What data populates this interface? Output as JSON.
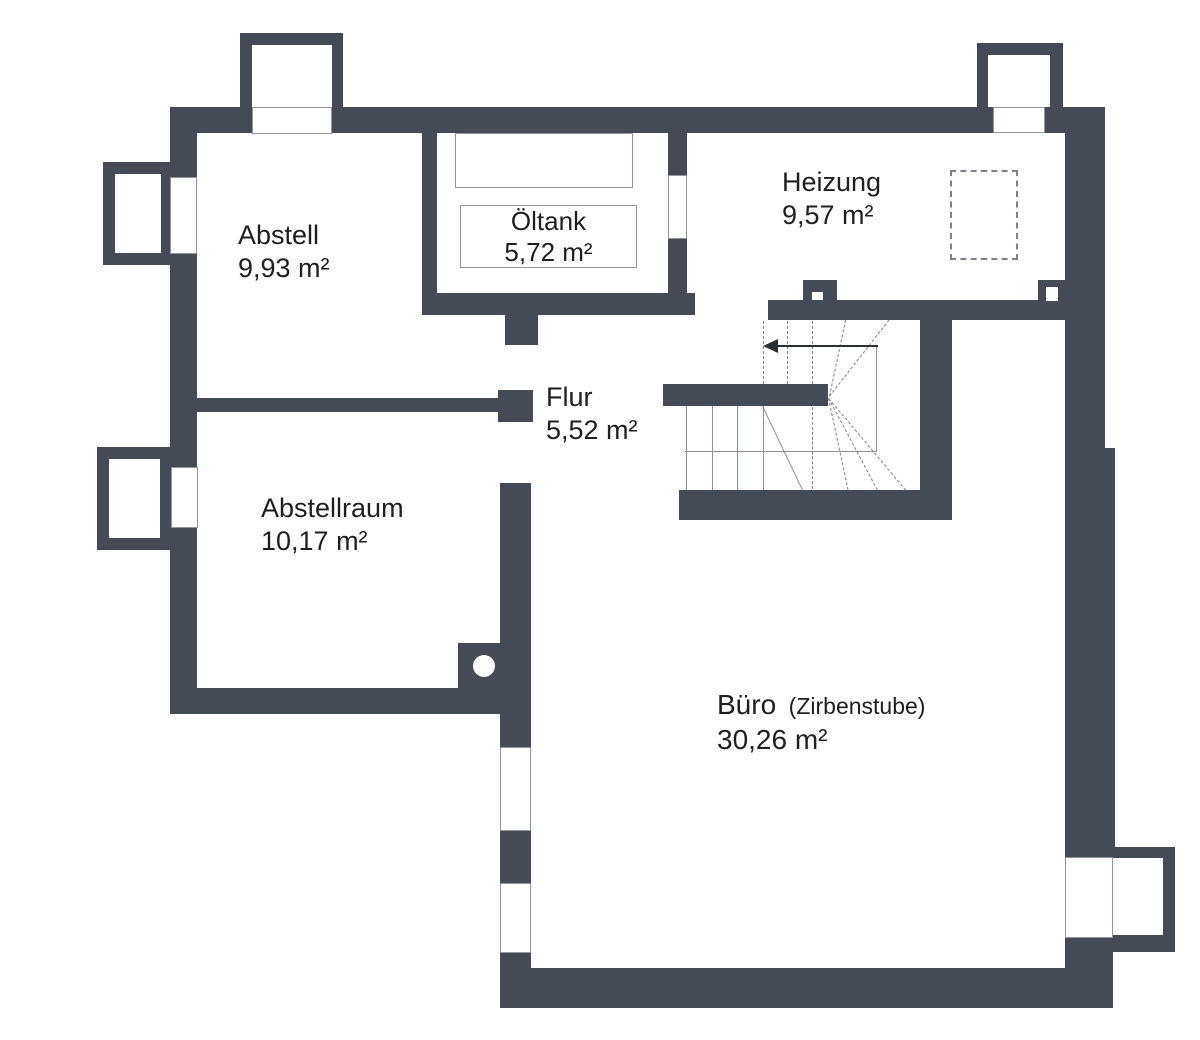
{
  "palette": {
    "wall": "#454b56",
    "thin_line": "#9097a0",
    "dashed_line": "#7d838d",
    "stair_line": "#8a9099",
    "arrow": "#2a2f36",
    "text": "#1f1f1f",
    "background": "#ffffff"
  },
  "rooms": {
    "abstell": {
      "name": "Abstell",
      "area": "9,93 m²"
    },
    "oeltank": {
      "name": "Öltank",
      "area": "5,72 m²"
    },
    "heizung": {
      "name": "Heizung",
      "area": "9,57 m²"
    },
    "flur": {
      "name": "Flur",
      "area": "5,52 m²"
    },
    "abstellraum": {
      "name": "Abstellraum",
      "area": "10,17 m²"
    },
    "buero": {
      "name": "Büro",
      "name_suffix": "(Zirbenstube)",
      "area": "30,26 m²"
    }
  }
}
